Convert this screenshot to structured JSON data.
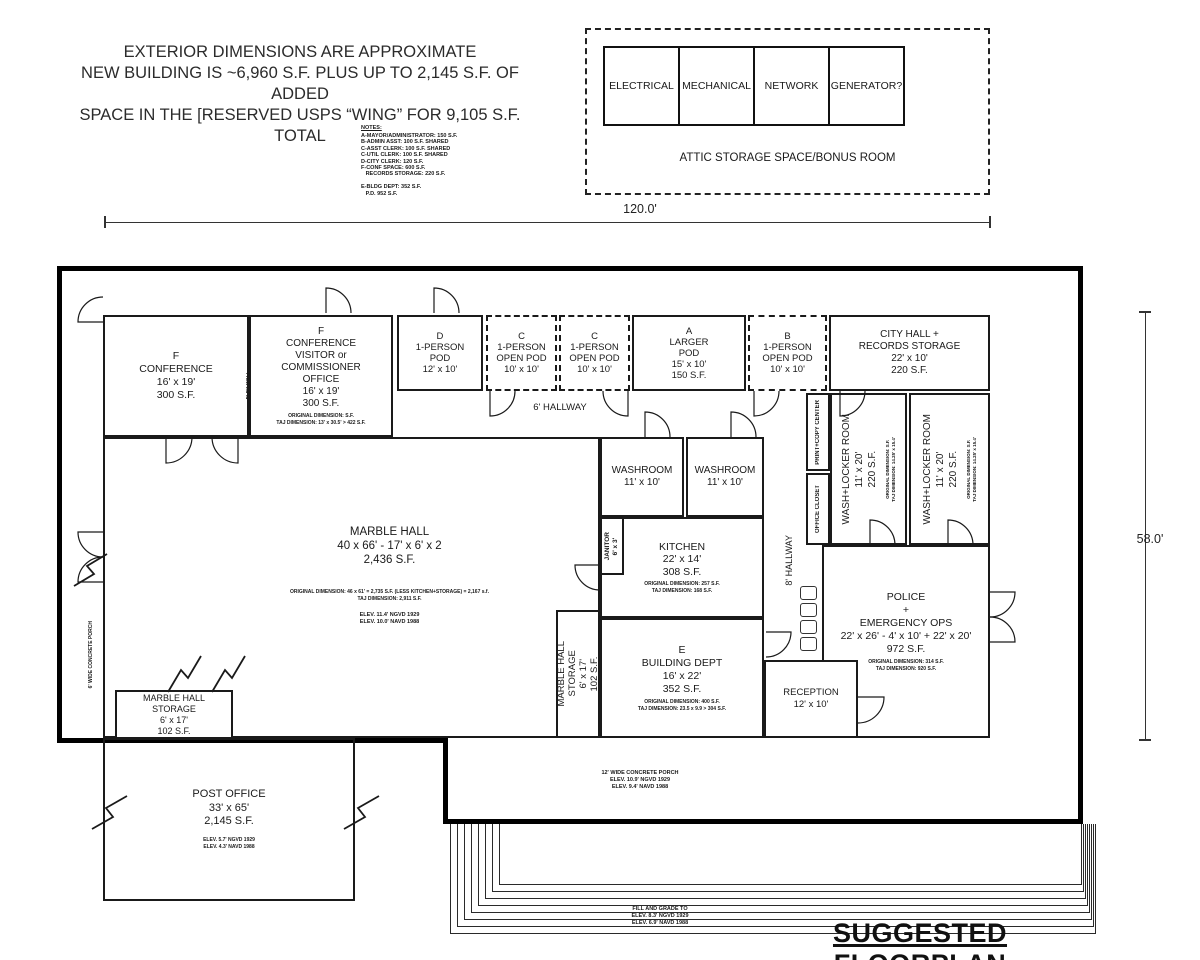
{
  "header": {
    "disclaimer": [
      "EXTERIOR DIMENSIONS ARE APPROXIMATE",
      "NEW BUILDING IS ~6,960 S.F. PLUS UP TO 2,145 S.F. OF ADDED",
      "SPACE IN THE [RESERVED USPS “WING” FOR 9,105 S.F. TOTAL"
    ],
    "notes_title": "NOTES:",
    "notes": [
      "A-MAYOR/ADMINISTRATOR: 150 S.F.",
      "B-ADMIN ASST: 100 S.F. SHARED",
      "C-ASST CLERK: 100 S.F. SHARED",
      "C-UTIL CLERK: 100 S.F. SHARED",
      "D-CITY CLERK: 120 S.F.",
      "F-CONF SPACE: 600 S.F.",
      "   RECORDS STORAGE: 220 S.F.",
      "",
      "E-BLDG DEPT: 352 S.F.",
      "   P.D. 952 S.F."
    ]
  },
  "attic": {
    "cells": [
      "ELECTRICAL",
      "MECHANICAL",
      "NETWORK",
      "GENERATOR?"
    ],
    "label": "ATTIC STORAGE SPACE/BONUS ROOM"
  },
  "dimensions": {
    "width": "120.0'",
    "height": "58.0'"
  },
  "rooms": {
    "conference_f": [
      "F",
      "CONFERENCE",
      "16' x 19'",
      "300 S.F."
    ],
    "flex_wall": "FLEX WALL",
    "conference_visitor": [
      "F",
      "CONFERENCE",
      "VISITOR or",
      "COMMISSIONER",
      "OFFICE",
      "16' x 19'",
      "300 S.F."
    ],
    "conference_visitor_small": [
      "ORIGINAL DIMENSION: S.F.",
      "TAJ DIMENSION: 13' x 30.5' > 422 S.F."
    ],
    "pod_d": [
      "D",
      "1-PERSON",
      "POD",
      "12' x 10'"
    ],
    "pod_c1": [
      "C",
      "1-PERSON",
      "OPEN POD",
      "10' x 10'"
    ],
    "pod_c2": [
      "C",
      "1-PERSON",
      "OPEN POD",
      "10' x 10'"
    ],
    "pod_a": [
      "A",
      "LARGER",
      "POD",
      "15' x 10'",
      "150 S.F."
    ],
    "pod_b": [
      "B",
      "1-PERSON",
      "OPEN POD",
      "10' x 10'"
    ],
    "city_hall": [
      "CITY HALL +",
      "RECORDS STORAGE",
      "22' x 10'",
      "220 S.F."
    ],
    "hallway_6": "6' HALLWAY",
    "washroom_1": [
      "WASHROOM",
      "11' x 10'"
    ],
    "washroom_2": [
      "WASHROOM",
      "11' x 10'"
    ],
    "janitor": [
      "JANITOR",
      "6' x 3'"
    ],
    "kitchen": [
      "KITCHEN",
      "22' x 14'",
      "308 S.F."
    ],
    "kitchen_small": [
      "ORIGINAL DIMENSION: 257 S.F.",
      "TAJ DIMENSION: 168 S.F."
    ],
    "marble_hall": [
      "MARBLE HALL",
      "40 x 66' - 17' x 6' x 2",
      "2,436 S.F."
    ],
    "marble_hall_small": [
      "ORIGINAL DIMENSION: 46 x 61' = 2,735 S.F. (LESS KITCHEN+STORAGE) = 2,167 s.f.",
      "TAJ DIMENSION: 2,911 S.F."
    ],
    "marble_hall_elev": [
      "ELEV. 11.4' NGVD 1929",
      "ELEV. 10.0' NAVD 1988"
    ],
    "marble_hall_storage_side": [
      "MARBLE HALL",
      "STORAGE",
      "6' x 17'",
      "102 S.F."
    ],
    "building_dept": [
      "E",
      "BUILDING DEPT",
      "16' x 22'",
      "352 S.F."
    ],
    "building_dept_small": [
      "ORIGINAL DIMENSION: 400 S.F.",
      "TAJ DIMENSION: 23.5 x 9.9 > 304 S.F."
    ],
    "hallway_8": "8' HALLWAY",
    "print_copy": "PRINT+COPY CENTER",
    "office_closet": "OFFICE CLOSET",
    "wash_locker": [
      "WASH+LOCKER ROOM",
      "11' x 20'",
      "220 S.F."
    ],
    "wash_locker_small": [
      "ORIGINAL DIMENSION: S.F.",
      "TAJ DIMENSION: 14.25' x 15.4'"
    ],
    "police": [
      "POLICE",
      "+",
      "EMERGENCY OPS",
      "22' x 26' - 4' x 10' + 22' x 20'",
      "972 S.F."
    ],
    "police_small": [
      "ORIGINAL DIMENSION: 314 S.F.",
      "TAJ DIMENSION: 920 S.F."
    ],
    "reception": [
      "RECEPTION",
      "12' x 10'"
    ],
    "marble_hall_storage": [
      "MARBLE HALL",
      "STORAGE",
      "6' x 17'",
      "102 S.F."
    ],
    "post_office": [
      "POST OFFICE",
      "33' x 65'",
      "2,145 S.F."
    ],
    "post_office_elev": [
      "ELEV. 5.7' NGVD 1929",
      "ELEV. 4.3' NAVD 1988"
    ]
  },
  "porch": {
    "left": "6' WIDE CONCRETE PORCH",
    "bottom": [
      "12' WIDE CONCRETE PORCH",
      "ELEV. 10.9' NGVD 1929",
      "ELEV. 9.4' NAVD 1988"
    ]
  },
  "footer": {
    "fill_grade": [
      "FILL AND GRADE TO",
      "ELEV. 8.3' NGVD 1929",
      "ELEV. 6.9' NAVD 1988"
    ],
    "title": "SUGGESTED FLOORPLAN"
  },
  "colors": {
    "ink": "#1a1a1a",
    "wall": "#000000",
    "background": "#ffffff"
  }
}
